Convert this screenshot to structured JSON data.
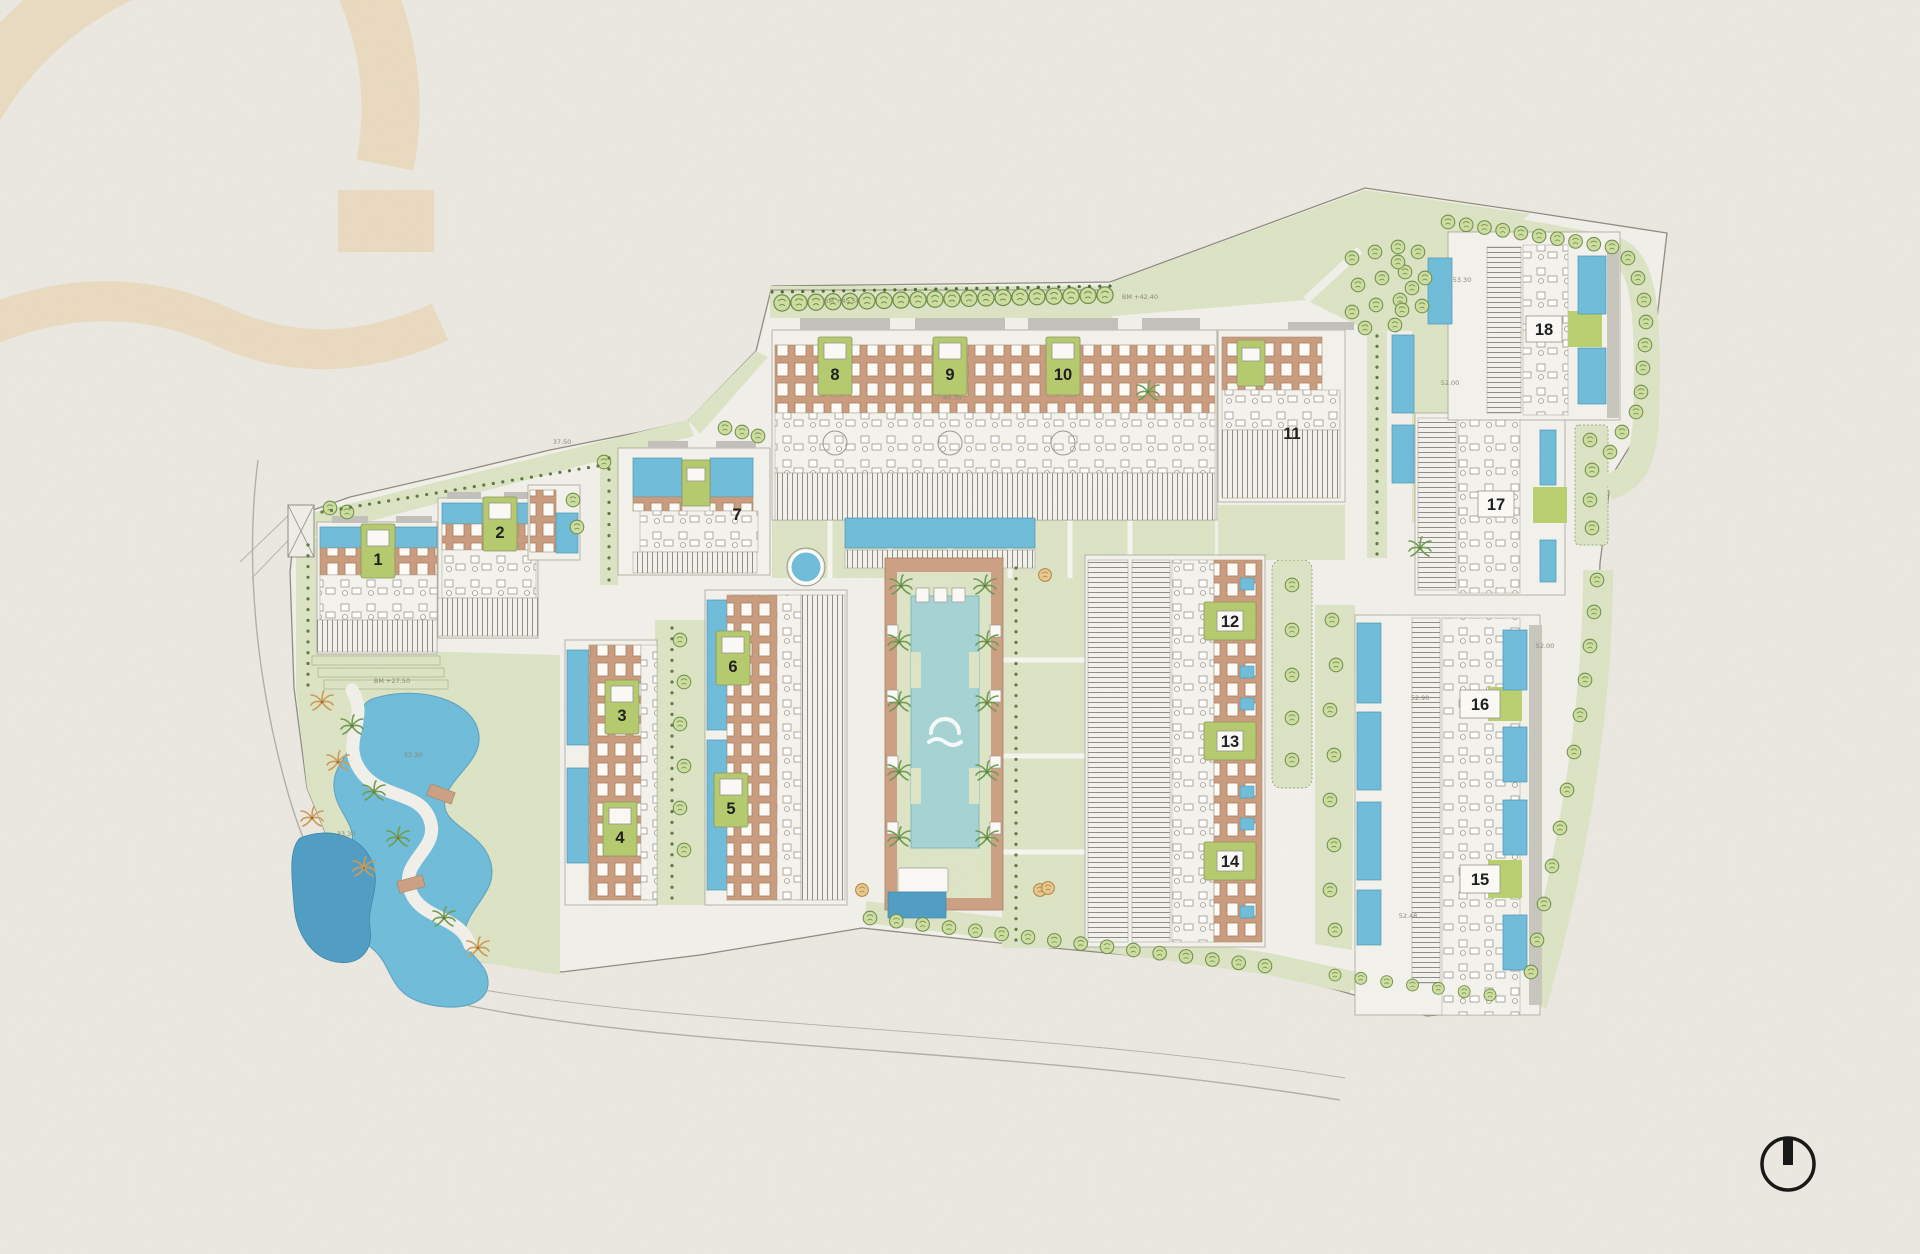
{
  "page": {
    "title": "Resort development master site plan",
    "kind": "architectural site plan drawing"
  },
  "colors": {
    "paper": "#ebe8e2",
    "ground": "#f2f0ea",
    "lawn": "#dce4c5",
    "lawnBright": "#b9d06e",
    "plaque": "#b5cb6d",
    "terra": "#cb9c7e",
    "deck": "#cda083",
    "pool": "#6fbcd9",
    "poolLight": "#a7d3d4",
    "poolDark": "#4f9dc4",
    "roof": "#c2c0ba",
    "stroke": "#8f8b80",
    "treeFill": "#cede9f",
    "treeStroke": "#6d8d4c",
    "palmGreen": "#6f9b52",
    "palmOrange": "#cf9a55",
    "north": "#141414",
    "annotation": "#8a8578",
    "watermark": "#e9d8bb"
  },
  "buildings": [
    {
      "label": "1"
    },
    {
      "label": "2"
    },
    {
      "label": "3"
    },
    {
      "label": "4"
    },
    {
      "label": "5"
    },
    {
      "label": "6"
    },
    {
      "label": "7"
    },
    {
      "label": "8"
    },
    {
      "label": "9"
    },
    {
      "label": "10"
    },
    {
      "label": "11"
    },
    {
      "label": "12"
    },
    {
      "label": "13"
    },
    {
      "label": "14"
    },
    {
      "label": "15"
    },
    {
      "label": "16"
    },
    {
      "label": "17"
    },
    {
      "label": "18"
    }
  ],
  "annotations": [
    {
      "text": "37.50"
    },
    {
      "text": "BM +45.50"
    },
    {
      "text": "40.70"
    },
    {
      "text": "BM +42.40"
    },
    {
      "text": "53.30"
    },
    {
      "text": "52.00"
    },
    {
      "text": "52.90"
    },
    {
      "text": "52.48"
    },
    {
      "text": "33.30"
    },
    {
      "text": "BM +27.50"
    },
    {
      "text": "33.30"
    },
    {
      "text": "52.00"
    }
  ],
  "symbols": {
    "north_arrow": "north-arrow",
    "logo_watermark": "arch-logo-watermark",
    "pool_logo": "arch-logo-pool-mark"
  }
}
